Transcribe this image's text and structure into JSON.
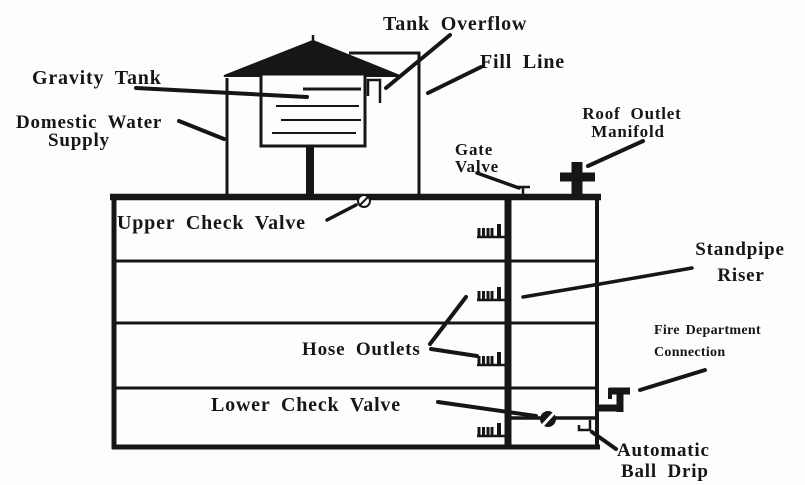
{
  "labels": {
    "tank_overflow": "Tank Overflow",
    "fill_line": "Fill Line",
    "gravity_tank": "Gravity Tank",
    "domestic_water_supply": {
      "line1": "Domestic Water",
      "line2": "Supply"
    },
    "roof_outlet_manifold": {
      "line1": "Roof Outlet",
      "line2": "Manifold"
    },
    "gate_valve": {
      "line1": "Gate",
      "line2": "Valve"
    },
    "upper_check_valve": "Upper Check Valve",
    "standpipe_riser": {
      "line1": "Standpipe",
      "line2": "Riser"
    },
    "hose_outlets": "Hose Outlets",
    "lower_check_valve": "Lower Check Valve",
    "fire_department_connection": {
      "line1": "Fire Department",
      "line2": "Connection"
    },
    "automatic_ball_drip": {
      "line1": "Automatic",
      "line2": "Ball Drip"
    }
  },
  "colors": {
    "ink": "#161616",
    "paper": "#fdfdfd"
  }
}
